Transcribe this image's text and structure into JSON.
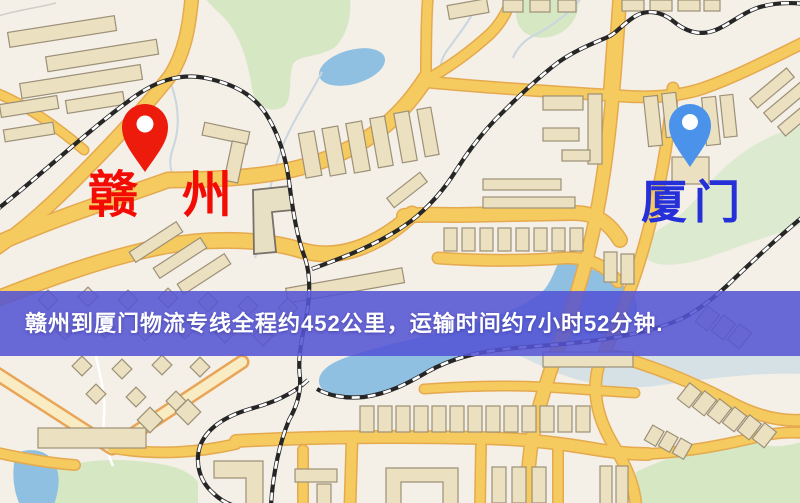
{
  "map": {
    "type": "stylized-street-map",
    "markers": [
      {
        "id": "ganzhou",
        "label": "赣州",
        "pin_color": "#ed1b0c",
        "label_color": "#f20c04",
        "pin_style": "red-drop-pin"
      },
      {
        "id": "xiamen",
        "label": "厦门",
        "pin_color": "#4b93ea",
        "label_color": "#2630d8",
        "pin_style": "blue-drop-pin"
      }
    ],
    "palette": {
      "background": "#f4efe7",
      "road_fill": "#f5cb60",
      "road_casing": "#e5a94e",
      "minor_road_fill": "#f9ecc2",
      "water": "#8fc0e2",
      "park": "#d6e7c4",
      "building": "#ebe1c0",
      "railway": "#262626"
    }
  },
  "banner": {
    "text": "赣州到厦门物流专线全程约452公里，运输时间约7小时52分钟.",
    "background_color": "#5454d4",
    "text_color": "#ffffff",
    "route": {
      "from": "赣州",
      "to": "厦门",
      "distance": "约452公里",
      "duration": "约7小时52分钟"
    }
  }
}
